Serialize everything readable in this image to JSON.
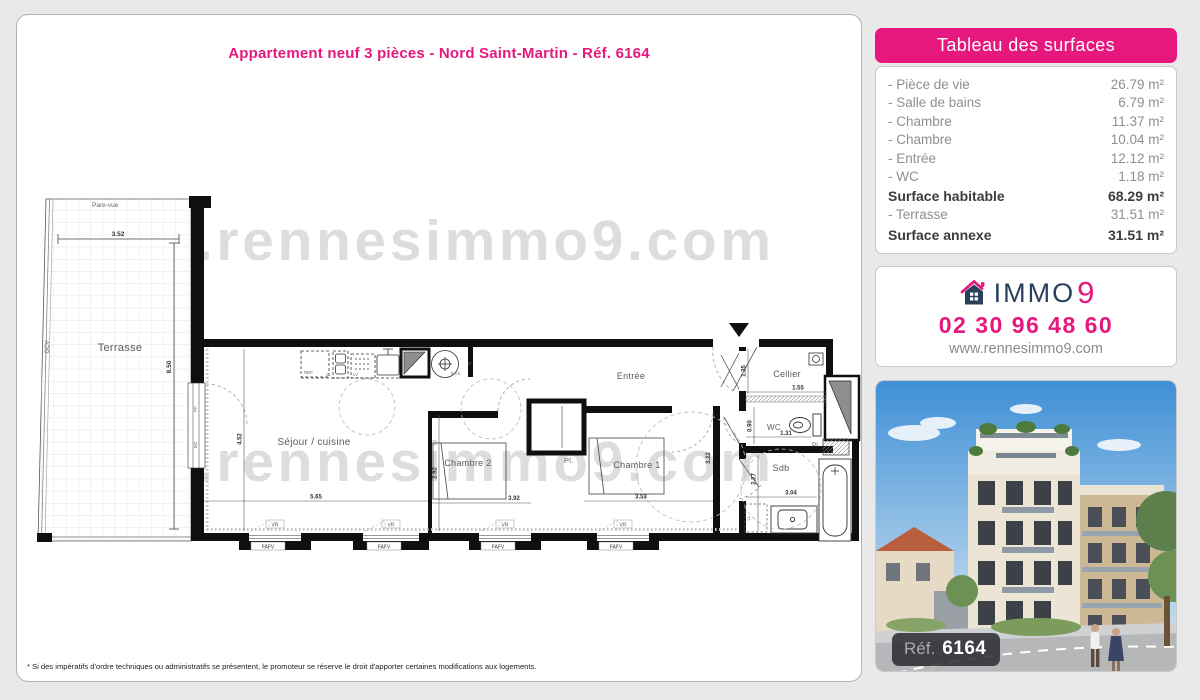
{
  "title": "Appartement neuf 3 pièces - Nord Saint-Martin - Réf. 6164",
  "watermark": "www.rennesimmo9.com",
  "footnote": "* Si des impératifs d'ordre techniques ou administratifs se présentent, le promoteur se réserve le droit d'apporter certaines modifications aux logements.",
  "colors": {
    "pink": "#e6187e",
    "navy": "#2a3f5c"
  },
  "surfaces_panel": {
    "header": "Tableau des surfaces",
    "rows": [
      {
        "label": "- Pièce de vie",
        "value": "26.79 m²"
      },
      {
        "label": "- Salle de bains",
        "value": "6.79 m²"
      },
      {
        "label": "- Chambre",
        "value": "11.37 m²"
      },
      {
        "label": "- Chambre",
        "value": "10.04 m²"
      },
      {
        "label": "- Entrée",
        "value": "12.12 m²"
      },
      {
        "label": "- WC",
        "value": "1.18 m²"
      },
      {
        "label": "Surface habitable",
        "value": "68.29 m²"
      },
      {
        "label": "- Terrasse",
        "value": "31.51 m²"
      },
      {
        "label": "Surface annexe",
        "value": "31.51 m²"
      }
    ]
  },
  "contact": {
    "brand": "IMMO",
    "brand_number": "9",
    "phone": "02 30 96 48 60",
    "website": "www.rennesimmo9.com"
  },
  "photo": {
    "ref_label": "Réf.",
    "ref_number": "6164"
  },
  "plan": {
    "terrasse": "Terrasse",
    "pare_vue": "Pare-vue",
    "gcv": "GCV",
    "sejour": "Séjour / cuisine",
    "chambre2": "Chambre 2",
    "chambre1": "Chambre 1",
    "entree": "Entrée",
    "cellier": "Cellier",
    "wc": "WC",
    "sdb": "Sdb",
    "placard": "Pl.",
    "placard2": "Pl.",
    "lave_linge": "LL",
    "appliances": {
      "ref": "REF",
      "cooktop": "C",
      "lv": "LV",
      "ecs": "ECS",
      "gas": "G"
    },
    "window_labels": {
      "pf": "PF",
      "m2": "M2",
      "vr": "VR",
      "fafv": "FAFV"
    },
    "dims": {
      "terrasse_w": "3.52",
      "terrasse_h": "8.50",
      "sejour_h": "4.52",
      "sejour_w": "5.65",
      "ch2_h": "2.92",
      "ch2_w": "3.92",
      "ch1_h": "3.22",
      "ch1_w": "3.53",
      "cellier_h": "1.35",
      "cellier_w": "1.55",
      "wc_h": "0.90",
      "wc_w": "1.31",
      "sdb_h": "2.27",
      "sdb_w": "3.04"
    }
  }
}
